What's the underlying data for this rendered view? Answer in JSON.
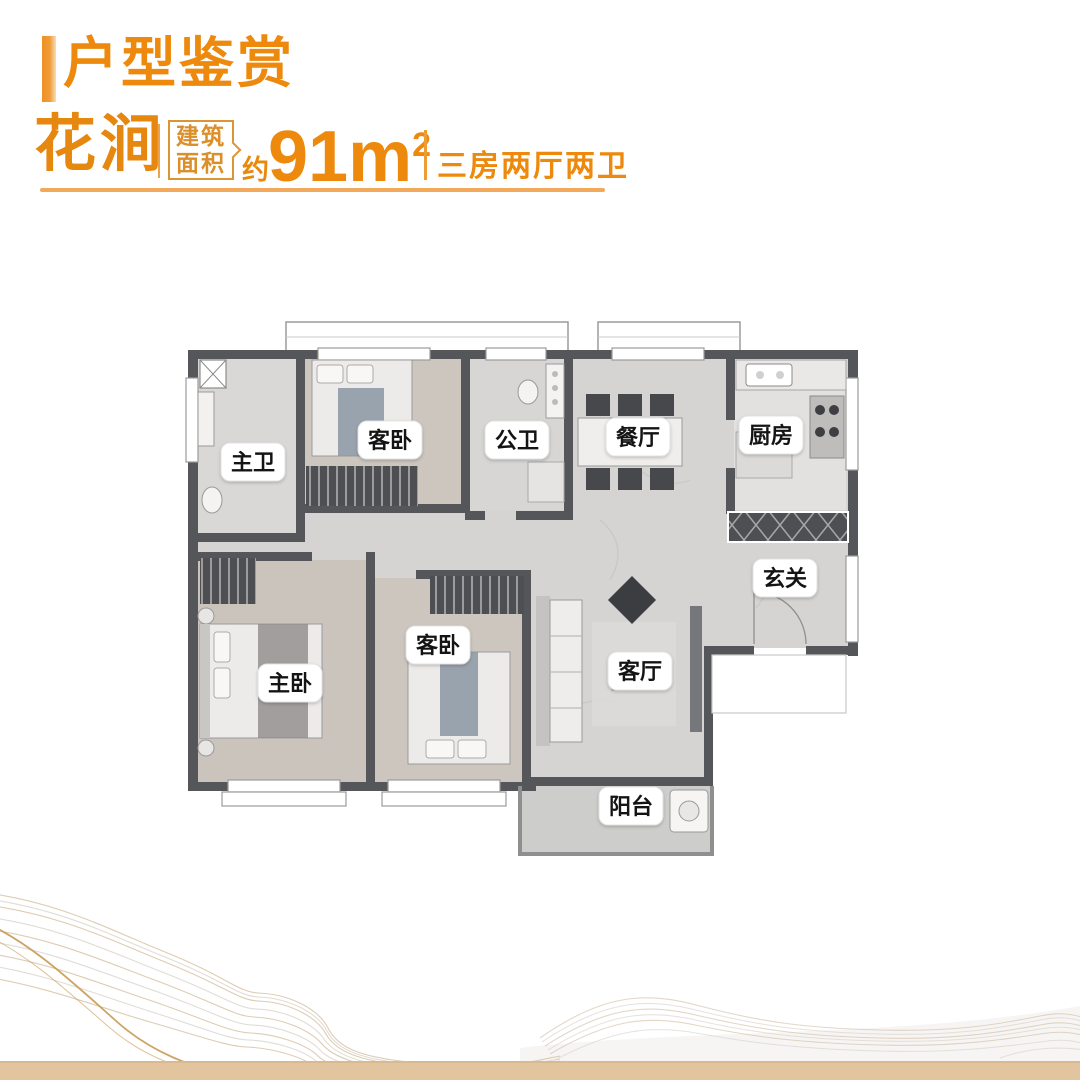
{
  "header": {
    "section_title": "户型鉴赏",
    "unit_name": "花涧",
    "area_box_line1": "建筑",
    "area_box_line2": "面积",
    "area_approx": "约",
    "area_value": "91",
    "area_unit": "m",
    "area_sup": "2",
    "layout_desc": "三房两厅两卫"
  },
  "floorplan": {
    "rooms": [
      {
        "id": "master-bath",
        "label": "主卫"
      },
      {
        "id": "guest-bedroom-upper",
        "label": "客卧"
      },
      {
        "id": "public-bath",
        "label": "公卫"
      },
      {
        "id": "dining-room",
        "label": "餐厅"
      },
      {
        "id": "kitchen",
        "label": "厨房"
      },
      {
        "id": "foyer",
        "label": "玄关"
      },
      {
        "id": "master-bedroom",
        "label": "主卧"
      },
      {
        "id": "guest-bedroom-lower",
        "label": "客卧"
      },
      {
        "id": "living-room",
        "label": "客厅"
      },
      {
        "id": "balcony",
        "label": "阳台"
      }
    ]
  },
  "colors": {
    "accent_orange": "#ED8A0D",
    "serif_gold": "#E6870F",
    "box_border": "#DB9634",
    "underline_gold": "#F2A95C",
    "wall_gray": "#55565A",
    "floor_marble": "#D6D4D2",
    "floor_wood": "#CDC6BF",
    "wave_tan": "#D2BB9B",
    "bottom_strip": "#E2C49E"
  }
}
